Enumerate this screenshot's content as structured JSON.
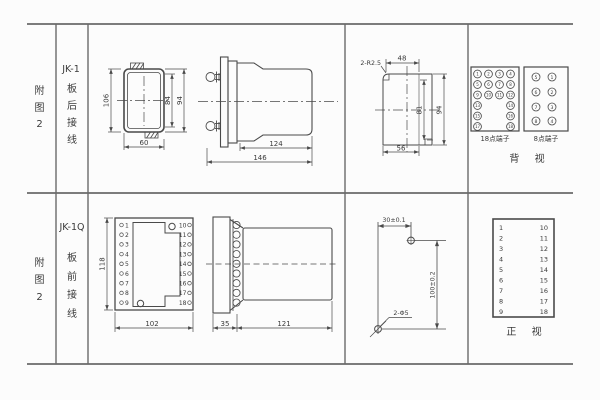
{
  "figure": {
    "row1": {
      "fig_no": "附图2",
      "model": "JK-1",
      "wiring": "板后接线"
    },
    "row2": {
      "fig_no": "附图2",
      "model": "JK-1Q",
      "wiring": "板前接线"
    }
  },
  "rear_view": {
    "dim_height": "106",
    "dim_inner_height": "84",
    "dim_outer_height": "94",
    "dim_width": "60"
  },
  "side_view": {
    "dim_body": "124",
    "dim_total": "146"
  },
  "cutout": {
    "note_radius": "2-R2.5",
    "dim_top": "48",
    "dim_inner": "81",
    "dim_outer": "94",
    "dim_bottom": "56"
  },
  "terminals_rear": {
    "label_18": "18点端子",
    "label_8": "8点端子",
    "view": "背 视",
    "t18": [
      "1",
      "2",
      "3",
      "4",
      "5",
      "6",
      "7",
      "8",
      "9",
      "10",
      "11",
      "12",
      "13",
      "14",
      "15",
      "16",
      "17",
      "18"
    ],
    "t8_left": [
      "5",
      "6",
      "7",
      "8"
    ],
    "t8_right": [
      "1",
      "2",
      "3",
      "4"
    ]
  },
  "front_view": {
    "dim_height": "118",
    "dim_width": "102",
    "left": [
      "1",
      "2",
      "3",
      "4",
      "5",
      "6",
      "7",
      "8",
      "9"
    ],
    "right": [
      "10",
      "11",
      "12",
      "13",
      "14",
      "15",
      "16",
      "17",
      "18"
    ]
  },
  "front_side": {
    "dim_plate": "35",
    "dim_body": "121"
  },
  "drill": {
    "dim_h": "30±0.1",
    "dim_v": "100±0.2",
    "note_holes": "2-Φ5"
  },
  "front_table": {
    "left": [
      "1",
      "2",
      "3",
      "4",
      "5",
      "6",
      "7",
      "8",
      "9"
    ],
    "right": [
      "10",
      "11",
      "12",
      "13",
      "14",
      "15",
      "16",
      "17",
      "18"
    ],
    "view": "正 视"
  }
}
